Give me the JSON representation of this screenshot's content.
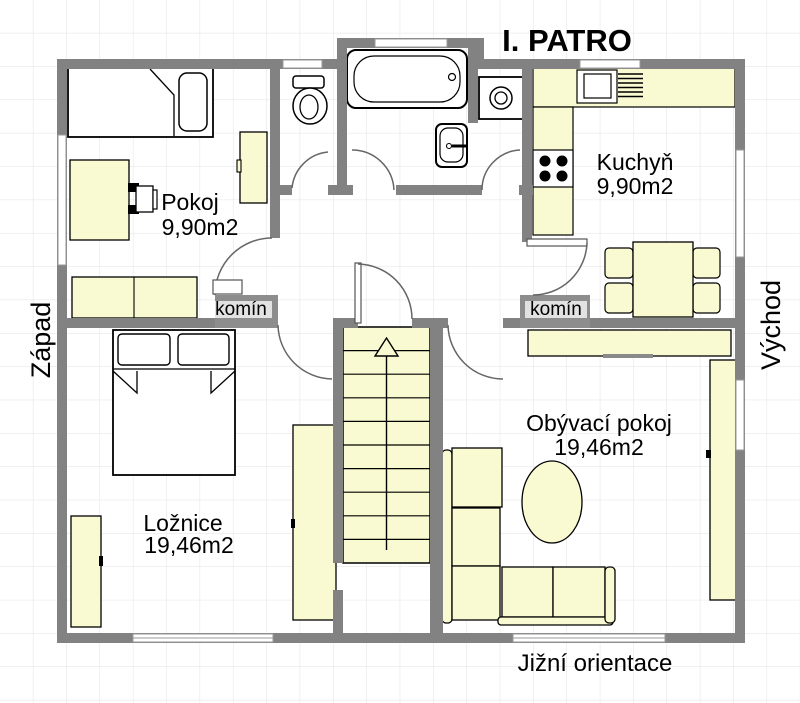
{
  "title": "I. PATRO",
  "orientation": {
    "west": "Západ",
    "east": "Východ",
    "south": "Jižní orientace"
  },
  "chimney_label": "komín",
  "rooms": {
    "pokoj": {
      "name": "Pokoj",
      "area": "9,90m2"
    },
    "kuchyn": {
      "name": "Kuchyň",
      "area": "9,90m2"
    },
    "loznice": {
      "name": "Ložnice",
      "area": "19,46m2"
    },
    "obyvaci": {
      "name": "Obývací pokoj",
      "area": "19,46m2"
    }
  },
  "colors": {
    "wall": "#828282",
    "chimney_block": "#8d8d8d",
    "furniture": "#FAFAD2",
    "grid": "#e2e2e2",
    "background": "#ffffff",
    "door_arc": "#666666"
  }
}
